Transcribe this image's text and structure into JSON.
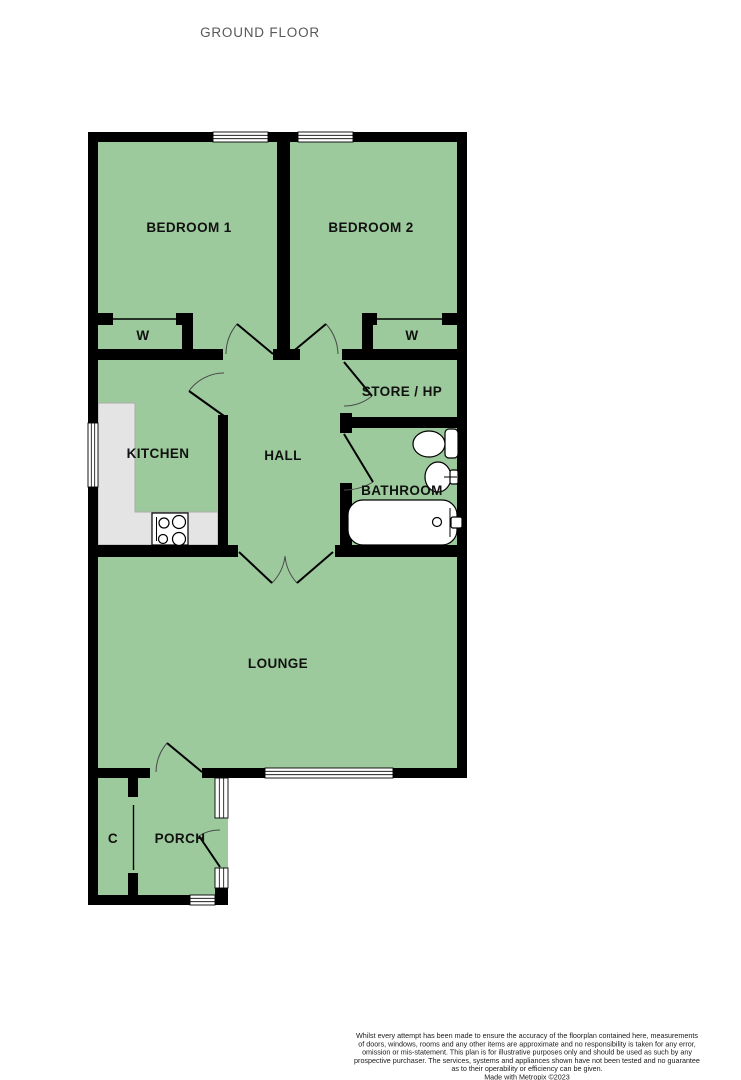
{
  "title": "GROUND FLOOR",
  "rooms": {
    "bedroom1": "BEDROOM 1",
    "bedroom2": "BEDROOM 2",
    "wardrobe_left": "W",
    "wardrobe_right": "W",
    "store": "STORE / HP",
    "kitchen": "KITCHEN",
    "hall": "HALL",
    "bathroom": "BATHROOM",
    "lounge": "LOUNGE",
    "porch": "PORCH",
    "cupboard": "C"
  },
  "footer": {
    "lines": [
      "Whilst every attempt has been made to ensure the accuracy of the floorplan contained here, measurements",
      "of doors, windows, rooms and any other items are approximate and no responsibility is taken for any error,",
      "omission or mis-statement. This plan is for illustrative purposes only and should be used as such by any",
      "prospective purchaser. The services, systems and appliances shown have not been tested and no guarantee",
      "as to their operability or efficiency can be given.",
      "Made with Metropix ©2023"
    ]
  },
  "colors": {
    "room_fill": "#9cca9c",
    "wall": "#000000",
    "window_fill": "#ffffff",
    "counter_fill": "#e4e4e4",
    "title_color": "#58585a"
  }
}
